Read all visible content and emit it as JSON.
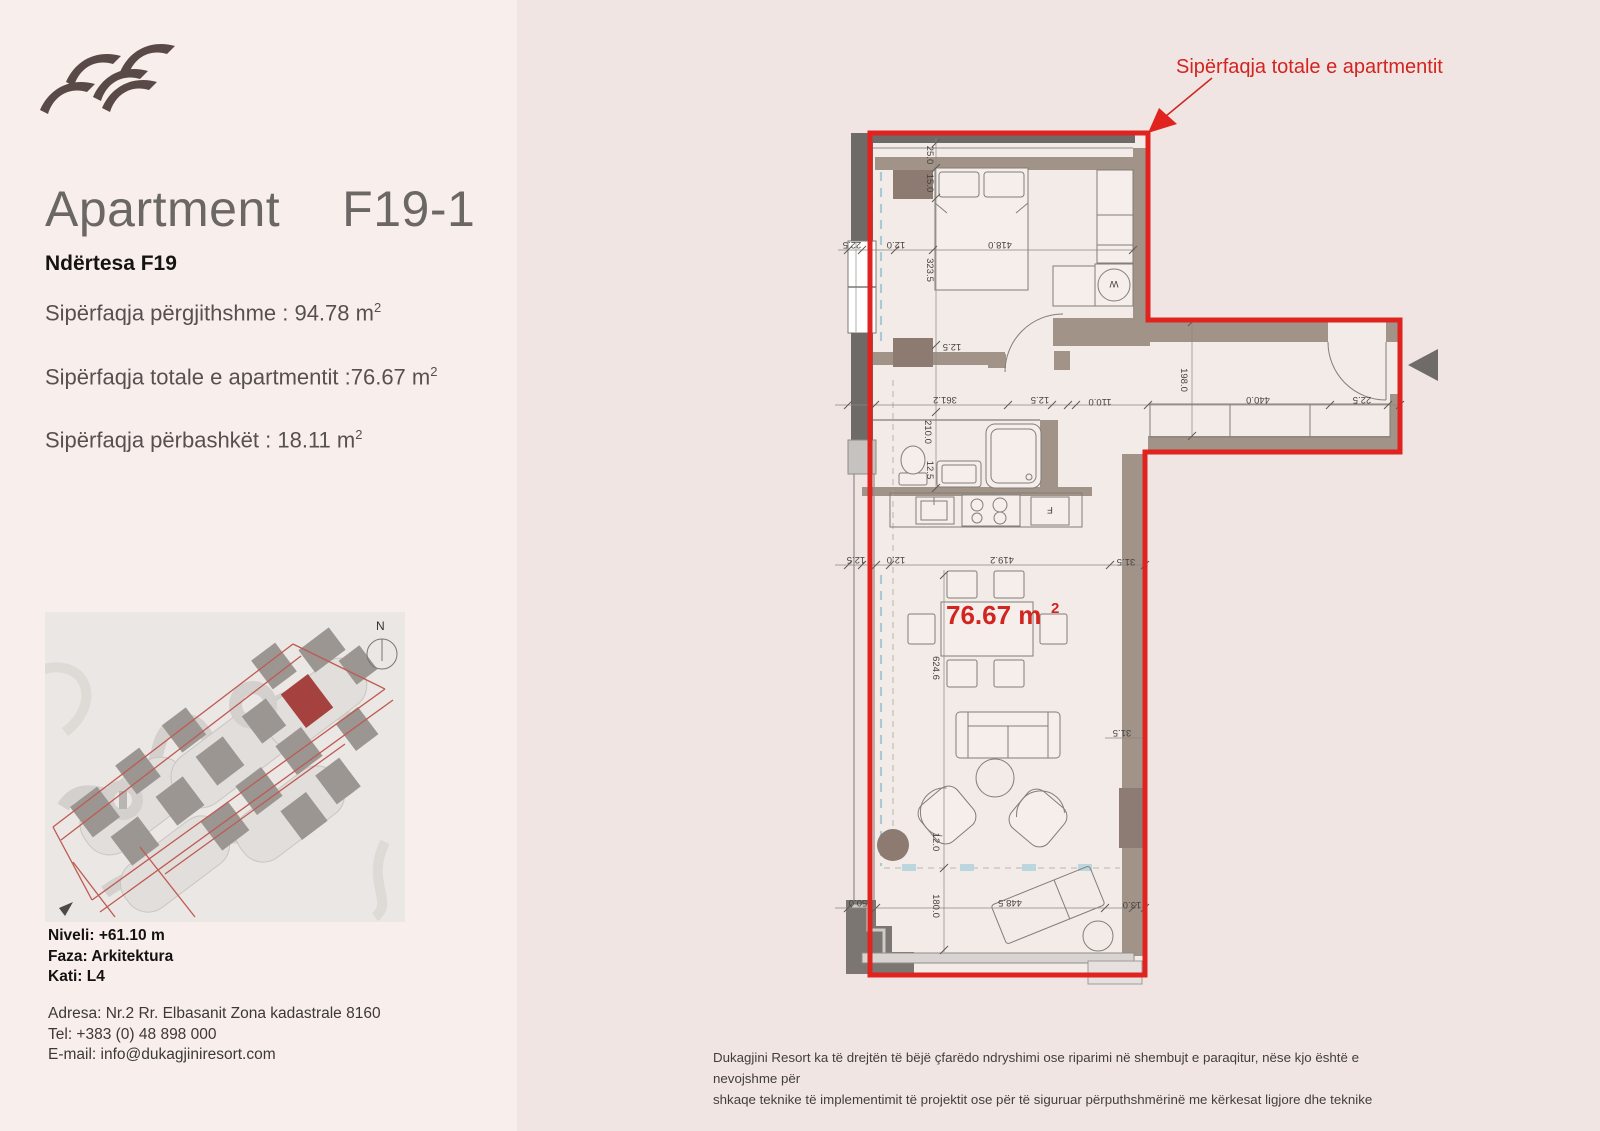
{
  "sidebar": {
    "title": "Apartment",
    "unit": "F19-1",
    "building": "Ndërtesa F19",
    "areas": [
      {
        "text": "Sipërfaqja përgjithshme : 94.78 m",
        "sup": "2"
      },
      {
        "text": "Sipërfaqja totale e apartmentit :76.67 m",
        "sup": "2"
      },
      {
        "text": "Sipërfaqja përbashkët : 18.11 m",
        "sup": "2"
      }
    ],
    "level": "Niveli: +61.10 m",
    "phase": "Faza: Arkitektura",
    "floor": "Kati: L4",
    "address": "Adresa: Nr.2 Rr. Elbasanit Zona kadastrale 8160",
    "phone": "Tel: +383 (0) 48 898 000",
    "email": "E-mail: info@dukagjiniresort.com",
    "map_compass": "N"
  },
  "plan": {
    "annotation": "Sipërfaqja totale e apartmentit",
    "area_value": "76.67 m",
    "area_sup": "2",
    "washer": "W",
    "fridge": "F",
    "dims": {
      "d01": "25.0",
      "d02": "15.0",
      "d03": "323.5",
      "d04": "418.0",
      "d05": "22.5",
      "d06": "12.0",
      "d07": "12.5",
      "d08": "361.2",
      "d09": "210.0",
      "d10": "12.5",
      "d11": "110.0",
      "d12": "198.0",
      "d13": "440.0",
      "d14": "22.5",
      "d15": "12.5",
      "d16": "12.5",
      "d17": "12.0",
      "d18": "419.2",
      "d19": "31.5",
      "d20": "624.6",
      "d21": "31.5",
      "d22": "12.0",
      "d23": "180.0",
      "d24": "448.5",
      "d25": "13.0",
      "d26": "50.0"
    }
  },
  "footer": {
    "line1": "Dukagjini Resort ka të drejtën të bëjë çfarëdo ndryshimi ose riparimi në shembujt e paraqitur, nëse kjo është e nevojshme për",
    "line2": "shkaqe teknike të implementimit të projektit ose për të siguruar përputhshmërinë me kërkesat ligjore dhe teknike"
  },
  "colors": {
    "accent_red": "#e0231f",
    "wall_taupe": "#a29388",
    "dark_wall": "#6e6a67",
    "map_highlight": "#a54240",
    "sidebar_bg": "#f8efec",
    "page_bg": "#f1e5e3"
  }
}
